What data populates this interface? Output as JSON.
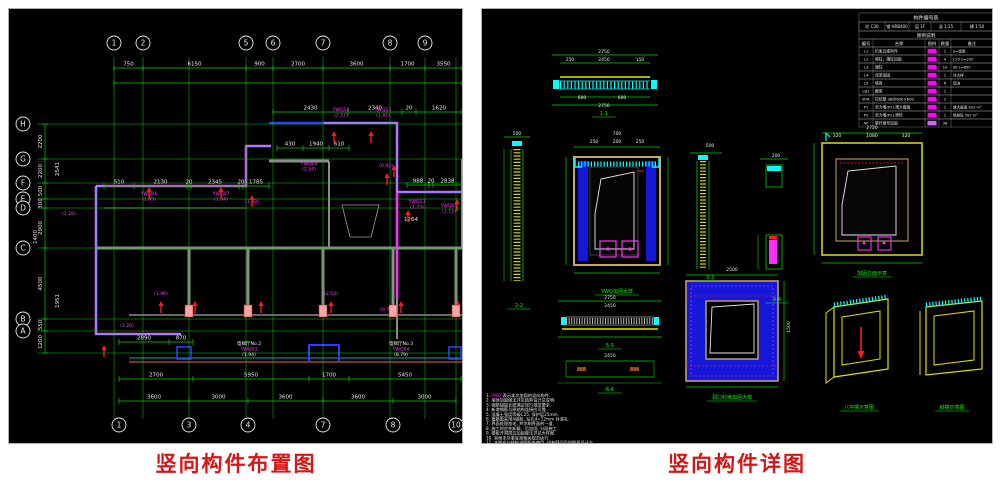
{
  "page": {
    "left_caption": "竖向构件布置图",
    "right_caption": "竖向构件详图"
  },
  "colors": {
    "dim_green": "#00d400",
    "bright_green": "#00ff00",
    "magenta": "#ff30ff",
    "cyan": "#00ffff",
    "red": "#ff1a1a",
    "blue": "#2a3cff",
    "yellow": "#e8e800",
    "tan": "#c8a85a",
    "wall_gray": "#8c8c8c",
    "white": "#e8e8e8",
    "caption_red": "#d91414"
  },
  "left": {
    "grid_v": [
      105,
      134,
      180,
      237,
      264,
      314,
      381,
      416,
      447
    ],
    "grid_h": [
      115,
      150,
      174,
      190,
      199,
      239,
      310,
      322,
      344
    ],
    "axes_top": [
      {
        "x": 105,
        "label": "1"
      },
      {
        "x": 134,
        "label": "2"
      },
      {
        "x": 237,
        "label": "5"
      },
      {
        "x": 264,
        "label": "6"
      },
      {
        "x": 314,
        "label": "7"
      },
      {
        "x": 381,
        "label": "8"
      },
      {
        "x": 416,
        "label": "9"
      }
    ],
    "axes_bottom": [
      {
        "x": 110,
        "label": "1"
      },
      {
        "x": 180,
        "label": "3"
      },
      {
        "x": 239,
        "label": "4"
      },
      {
        "x": 314,
        "label": "7"
      },
      {
        "x": 384,
        "label": "8"
      },
      {
        "x": 447,
        "label": "10"
      }
    ],
    "axes_left": [
      {
        "y": 115,
        "label": "H"
      },
      {
        "y": 150,
        "label": "G"
      },
      {
        "y": 174,
        "label": "F"
      },
      {
        "y": 190,
        "label": "E"
      },
      {
        "y": 199,
        "label": "D"
      },
      {
        "y": 239,
        "label": "C"
      },
      {
        "y": 310,
        "label": "B"
      },
      {
        "y": 322,
        "label": "A"
      }
    ],
    "dim_chains": [
      {
        "type": "h",
        "y": 59,
        "x1": 105,
        "x2": 453,
        "ticks": [
          105,
          134,
          237,
          264,
          314,
          381,
          416,
          453
        ],
        "values": [
          "750",
          "6150",
          "900",
          "2700",
          "3600",
          "1700",
          "3550"
        ]
      },
      {
        "type": "h",
        "y": 74,
        "x1": 105,
        "x2": 453,
        "ticks": [
          105,
          453
        ],
        "values": []
      },
      {
        "type": "h",
        "y": 103,
        "x1": 264,
        "x2": 453,
        "ticks": [
          264,
          339,
          393,
          407,
          453
        ],
        "values": [
          "2430",
          "2340",
          "20",
          "1620"
        ]
      },
      {
        "type": "h",
        "y": 139,
        "x1": 268,
        "x2": 340,
        "ticks": [
          268,
          294,
          320,
          340
        ],
        "values": [
          "430",
          "1940",
          "610"
        ]
      },
      {
        "type": "h",
        "y": 177,
        "x1": 95,
        "x2": 260,
        "ticks": [
          95,
          125,
          178,
          182,
          230,
          234,
          260
        ],
        "values": [
          "510",
          "2130",
          "20",
          "2345",
          "20",
          "1785"
        ]
      },
      {
        "type": "h",
        "y": 176,
        "x1": 398,
        "x2": 453,
        "ticks": [
          398,
          420,
          424,
          453
        ],
        "values": [
          "988",
          "20",
          "2838"
        ]
      },
      {
        "type": "h",
        "y": 333,
        "x1": 110,
        "x2": 184,
        "ticks": [
          110,
          160,
          184
        ],
        "values": [
          "2890",
          "870"
        ]
      },
      {
        "type": "h",
        "y": 370,
        "x1": 110,
        "x2": 452,
        "ticks": [
          110,
          184,
          300,
          340,
          452
        ],
        "values": [
          "2700",
          "5950",
          "1700",
          "5450"
        ]
      },
      {
        "type": "h",
        "y": 392,
        "x1": 110,
        "x2": 447,
        "ticks": [
          110,
          180,
          239,
          314,
          384,
          447
        ],
        "values": [
          "3600",
          "3000",
          "3600",
          "3600",
          "3000"
        ]
      },
      {
        "type": "v",
        "x": 36,
        "y1": 115,
        "y2": 344,
        "ticks": [
          115,
          150,
          174,
          190,
          199,
          239,
          310,
          322,
          344
        ],
        "values": [
          "2200",
          "2200",
          "500",
          "300",
          "2900",
          "4500",
          "550",
          "1200"
        ]
      }
    ],
    "texts": [
      {
        "x": 402,
        "y": 212,
        "t": "1264"
      },
      {
        "x": 28,
        "y": 228,
        "t": "1400",
        "r": -90
      },
      {
        "x": 50,
        "y": 160,
        "t": "2541",
        "r": -90
      },
      {
        "x": 50,
        "y": 292,
        "t": "1951",
        "r": -90
      }
    ],
    "labels": [
      {
        "x": 140,
        "y": 186,
        "lines": [
          "YWQ06",
          "(1.49)"
        ]
      },
      {
        "x": 212,
        "y": 186,
        "lines": [
          "YWQ07",
          "(1.04)"
        ]
      },
      {
        "x": 243,
        "y": 194,
        "lines": [
          "(1.38)"
        ]
      },
      {
        "x": 332,
        "y": 102,
        "lines": [
          "YWQ10",
          "(2.57)"
        ]
      },
      {
        "x": 374,
        "y": 102,
        "lines": [
          "YWQ11",
          "(1.81)"
        ]
      },
      {
        "x": 300,
        "y": 156,
        "lines": [
          "YWQ09",
          "(2.54)"
        ]
      },
      {
        "x": 377,
        "y": 158,
        "lines": [
          "(0.92)"
        ]
      },
      {
        "x": 408,
        "y": 194,
        "lines": [
          "YWQ13",
          "(1.73)"
        ]
      },
      {
        "x": 440,
        "y": 198,
        "lines": [
          "YWQ05",
          "(2.15)"
        ]
      },
      {
        "x": 118,
        "y": 318,
        "lines": [
          "(1.28)"
        ]
      },
      {
        "x": 60,
        "y": 206,
        "lines": [
          "(1.28)"
        ]
      },
      {
        "x": 378,
        "y": 302,
        "lines": [
          "(0.76)"
        ]
      },
      {
        "x": 152,
        "y": 286,
        "lines": [
          "(1.96)"
        ]
      },
      {
        "x": 322,
        "y": 286,
        "lines": [
          "(2.54)"
        ]
      },
      {
        "x": 240,
        "y": 336,
        "lines": [
          "电梯厅No.2",
          "YWQ03",
          "(1.94)"
        ],
        "colors": [
          "#e8e8e8",
          "#ff30ff",
          "#e8e8e8"
        ]
      },
      {
        "x": 392,
        "y": 336,
        "lines": [
          "电梯厅No.3",
          "YWQ04",
          "(8.79)"
        ],
        "colors": [
          "#e8e8e8",
          "#ff30ff",
          "#e8e8e8"
        ]
      }
    ],
    "arrows": [
      [
        140,
        178
      ],
      [
        212,
        178
      ],
      [
        243,
        186
      ],
      [
        325,
        122
      ],
      [
        362,
        122
      ],
      [
        385,
        156
      ],
      [
        378,
        164
      ],
      [
        399,
        201
      ],
      [
        448,
        190
      ],
      [
        152,
        292
      ],
      [
        186,
        292
      ],
      [
        252,
        292
      ],
      [
        322,
        292
      ],
      [
        392,
        292
      ],
      [
        449,
        292
      ],
      [
        95,
        336
      ]
    ],
    "piers": [
      180,
      239,
      314,
      384,
      447
    ]
  },
  "right": {
    "table": {
      "x": 377,
      "y": 4,
      "w": 134,
      "title": "构件编号表",
      "info": [
        "砼 C30",
        "钢 HRB400",
        "层 1F",
        "竖 1:25",
        "横 1:50"
      ],
      "info_widths": [
        26,
        24,
        22,
        30,
        32
      ],
      "subtitle": "图例说明",
      "header": [
        "编号",
        "名称",
        "图例",
        "数量",
        "备注"
      ],
      "col_widths": [
        14,
        52,
        14,
        12,
        42
      ],
      "rows": [
        {
          "code": "L1",
          "name": "约束边缘构件",
          "swatch": "#ff00ff",
          "qty": "1",
          "remark": "b=墙厚"
        },
        {
          "code": "L2",
          "name": "暗柱、端柱加固",
          "swatch": "#ff00ff",
          "qty": "4",
          "remark": "C25 b=200"
        },
        {
          "code": "L3",
          "name": "端柱",
          "swatch": "#ff00ff",
          "qty": "10",
          "remark": "d8 L=600"
        },
        {
          "code": "L4",
          "name": "连梁加固",
          "swatch": "#ff00ff",
          "qty": "1",
          "remark": "详大样"
        },
        {
          "code": "L5",
          "name": "墙身",
          "swatch": "#ff00ff",
          "qty": "6",
          "remark": "现浇"
        },
        {
          "code": "LB1",
          "name": "圈梁",
          "swatch": "#ff00ff",
          "qty": "1",
          "remark": ""
        },
        {
          "code": "BTA",
          "name": "拉结筋 d8@600×600",
          "swatch": "#ff00ff",
          "qty": "2",
          "remark": ""
        },
        {
          "code": "P1",
          "name": "剪力墙(P1)·增大截面",
          "swatch": "#ff00ff",
          "qty": "1",
          "remark": "增大截面 632 m²"
        },
        {
          "code": "P2",
          "name": "剪力墙(P2)·喷砼",
          "swatch": "#ff00ff",
          "qty": "1",
          "remark": "喷射砼 587 m²"
        },
        {
          "code": "AP",
          "name": "碳纤维布加固",
          "swatch": "#cc66ff",
          "qty": "36",
          "remark": ""
        }
      ]
    },
    "texts": [
      {
        "x": 122,
        "y": 44,
        "t": "2750"
      },
      {
        "x": 88,
        "y": 52,
        "t": "250"
      },
      {
        "x": 122,
        "y": 52,
        "t": "2450"
      },
      {
        "x": 158,
        "y": 52,
        "t": "150"
      },
      {
        "x": 100,
        "y": 90,
        "t": "600"
      },
      {
        "x": 140,
        "y": 90,
        "t": "600"
      },
      {
        "x": 122,
        "y": 98,
        "t": "2750"
      },
      {
        "x": 35,
        "y": 126,
        "t": "500"
      },
      {
        "x": 135,
        "y": 126,
        "t": "700"
      },
      {
        "x": 112,
        "y": 134,
        "t": "250"
      },
      {
        "x": 135,
        "y": 134,
        "t": "200"
      },
      {
        "x": 158,
        "y": 134,
        "t": "250"
      },
      {
        "x": 228,
        "y": 138,
        "t": "500"
      },
      {
        "x": 294,
        "y": 148,
        "t": "200"
      },
      {
        "x": 390,
        "y": 120,
        "t": "2720"
      },
      {
        "x": 355,
        "y": 128,
        "t": "320"
      },
      {
        "x": 390,
        "y": 128,
        "t": "1080"
      },
      {
        "x": 424,
        "y": 128,
        "t": "320"
      },
      {
        "x": 128,
        "y": 290,
        "t": "2750"
      },
      {
        "x": 128,
        "y": 298,
        "t": "2450"
      },
      {
        "x": 128,
        "y": 348,
        "t": "2450"
      },
      {
        "x": 250,
        "y": 262,
        "t": "2500"
      },
      {
        "x": 308,
        "y": 318,
        "t": "1500",
        "r": -90
      }
    ],
    "captions": [
      {
        "x": 122,
        "y": 106,
        "t": "1-1"
      },
      {
        "x": 37,
        "y": 298,
        "t": "2-2"
      },
      {
        "x": 135,
        "y": 284,
        "t": "YWQ加固大样"
      },
      {
        "x": 228,
        "y": 270,
        "t": "3-3"
      },
      {
        "x": 295,
        "y": 292,
        "t": "4-4"
      },
      {
        "x": 390,
        "y": 266,
        "t": "加固立面示意"
      },
      {
        "x": 128,
        "y": 338,
        "t": "5-5"
      },
      {
        "x": 128,
        "y": 382,
        "t": "6-6"
      },
      {
        "x": 250,
        "y": 390,
        "t": "洞口封堵加固大样"
      },
      {
        "x": 377,
        "y": 400,
        "t": "八字撑示意图"
      },
      {
        "x": 470,
        "y": 400,
        "t": "斜撑示意图"
      }
    ],
    "notes": {
      "first": {
        "pre": "1. ",
        "hl": "YWQ",
        "post": " 表示本次加固的竖向构件."
      },
      "lines": [
        "2. 墙体加固做法详见结构设计总说明.",
        "3. 钢筋锚固长度满足现行规范要求.",
        "4. 新增钢筋与原结构连接应可靠.",
        "5. 混凝土强度等级C25, 保护层25mm.",
        "6. 植筋胶采用A级胶, 钻孔d=12mm 并清孔.",
        "7. 界面处理凿毛, 并涂刷界面剂一道.",
        "8. 施工时应先卸载、后加固, 分段施工.",
        "9. 楼板开洞周边加固做法详见大样图.",
        "10. 其他未尽事宜按相关规范执行.",
        "11. 本图应与结构说明配合使用, 如有疑问及时联系设计方."
      ]
    }
  }
}
